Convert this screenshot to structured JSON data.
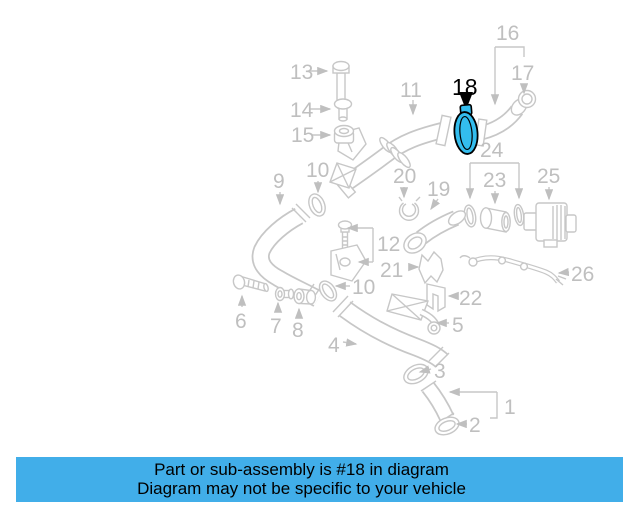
{
  "banner": {
    "line1": "Part or sub-assembly is #18 in diagram",
    "line2": "Diagram may not be specific to your vehicle"
  },
  "highlighted_part": "18",
  "colors": {
    "banner_background": "#41aee9",
    "banner_text": "#000000",
    "highlight_fill": "#33bdee",
    "highlight_outline": "#000000",
    "diagram_line": "#c7c7c7",
    "callout_text": "#bfbfbf"
  },
  "callouts": {
    "c1": "1",
    "c2": "2",
    "c3": "3",
    "c4": "4",
    "c5": "5",
    "c6": "6",
    "c7": "7",
    "c8": "8",
    "c9": "9",
    "c10a": "10",
    "c10b": "10",
    "c11": "11",
    "c12": "12",
    "c13": "13",
    "c14": "14",
    "c15": "15",
    "c16": "16",
    "c17": "17",
    "c18": "18",
    "c19": "19",
    "c20": "20",
    "c21": "21",
    "c22": "22",
    "c23": "23",
    "c24": "24",
    "c25": "25",
    "c26": "26"
  }
}
